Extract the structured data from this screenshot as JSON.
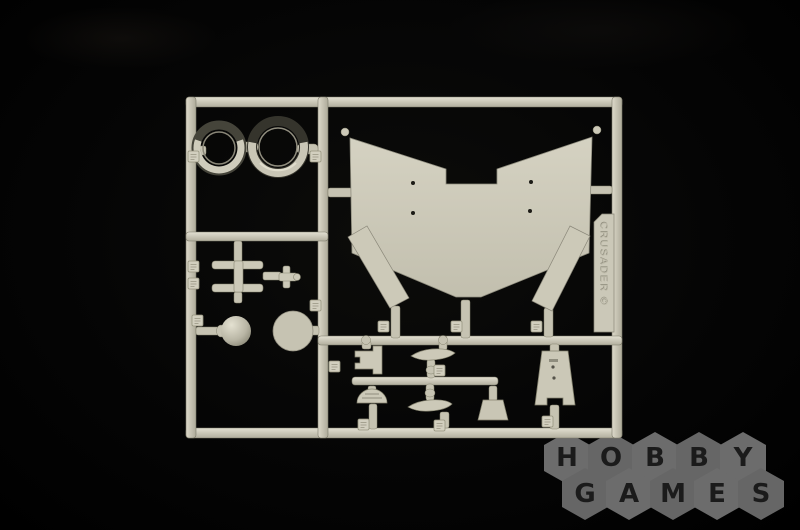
{
  "scene": {
    "subject": "light grey plastic model kit sprue photographed on a black background",
    "colors": {
      "background": "#030303",
      "plastic_light": "#d6d3c3",
      "plastic_mid": "#c8c5b4",
      "plastic_shadow": "#8f8d7d",
      "ring_dark": "#35342c",
      "logo_hexagon": "#6c6c6c",
      "logo_letter": "#1b1b1b"
    }
  },
  "sprue": {
    "embossed_label": "CRUSADER ©",
    "parts": [
      {
        "id": "ring-small",
        "label": "small ring"
      },
      {
        "id": "ring-large",
        "label": "large ring"
      },
      {
        "id": "hull-panel",
        "label": "V-shaped hull panel with four holes and ball pins at the tips"
      },
      {
        "id": "fender-left",
        "label": "left angled fender strip"
      },
      {
        "id": "fender-right",
        "label": "right angled fender strip"
      },
      {
        "id": "beam-part",
        "label": "twin-bar beam with rod and cross fitting"
      },
      {
        "id": "ball-part",
        "label": "spherical part on a neck"
      },
      {
        "id": "disc-part",
        "label": "flat round disc"
      },
      {
        "id": "bracket-part",
        "label": "stepped bracket"
      },
      {
        "id": "blade-upper",
        "label": "pointed blade with spindle"
      },
      {
        "id": "blade-lower",
        "label": "pointed blade with spindle"
      },
      {
        "id": "half-dome",
        "label": "half-round base part"
      },
      {
        "id": "bucket-part",
        "label": "small trapezoid scoop"
      },
      {
        "id": "shield-panel",
        "label": "tapered shield panel with slot and holes"
      },
      {
        "id": "number-tags",
        "label": "small embossed part-number tabs on the runners"
      }
    ]
  },
  "watermark": {
    "brand": "HOBBY GAMES",
    "row1": [
      "H",
      "O",
      "B",
      "B",
      "Y"
    ],
    "row2": [
      "G",
      "A",
      "M",
      "E",
      "S"
    ]
  }
}
